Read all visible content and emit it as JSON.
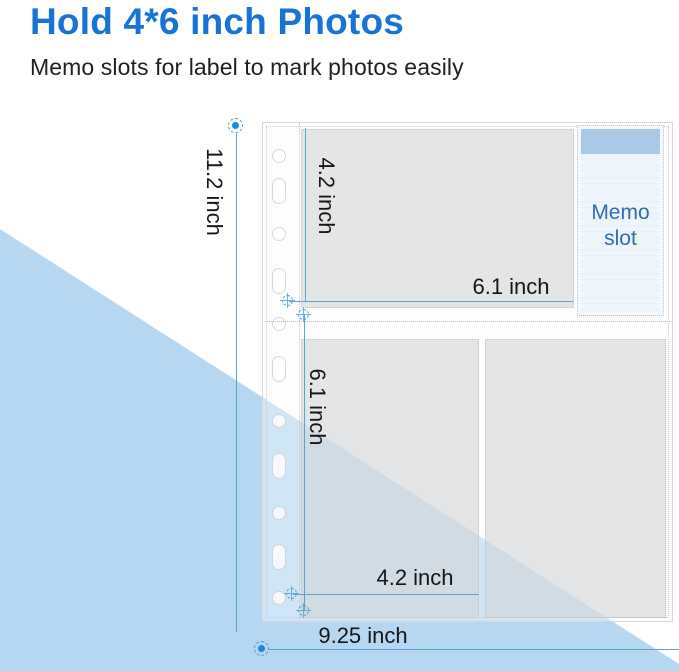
{
  "page": {
    "title": "Hold 4*6 inch Photos",
    "subtitle": "Memo slots for label to mark photos easily"
  },
  "diagram": {
    "memo_slot": {
      "line1": "Memo",
      "line2": "slot"
    },
    "dimensions": {
      "sheet_height": "11.2 inch",
      "top_pocket_height": "4.2 inch",
      "top_pocket_width": "6.1 inch",
      "bottom_pocket_height": "6.1 inch",
      "bottom_pocket_width": "4.2 inch",
      "sheet_width": "9.25 inch"
    },
    "colors": {
      "title_blue": "#1774d4",
      "dimension_line_blue": "#5aa5cd",
      "background_triangle_blue": "#b5d7f2",
      "memo_band_blue": "#a9c9e8",
      "memo_text_blue": "#2e6cb4",
      "pocket_gray": "#e9e9e9"
    }
  }
}
